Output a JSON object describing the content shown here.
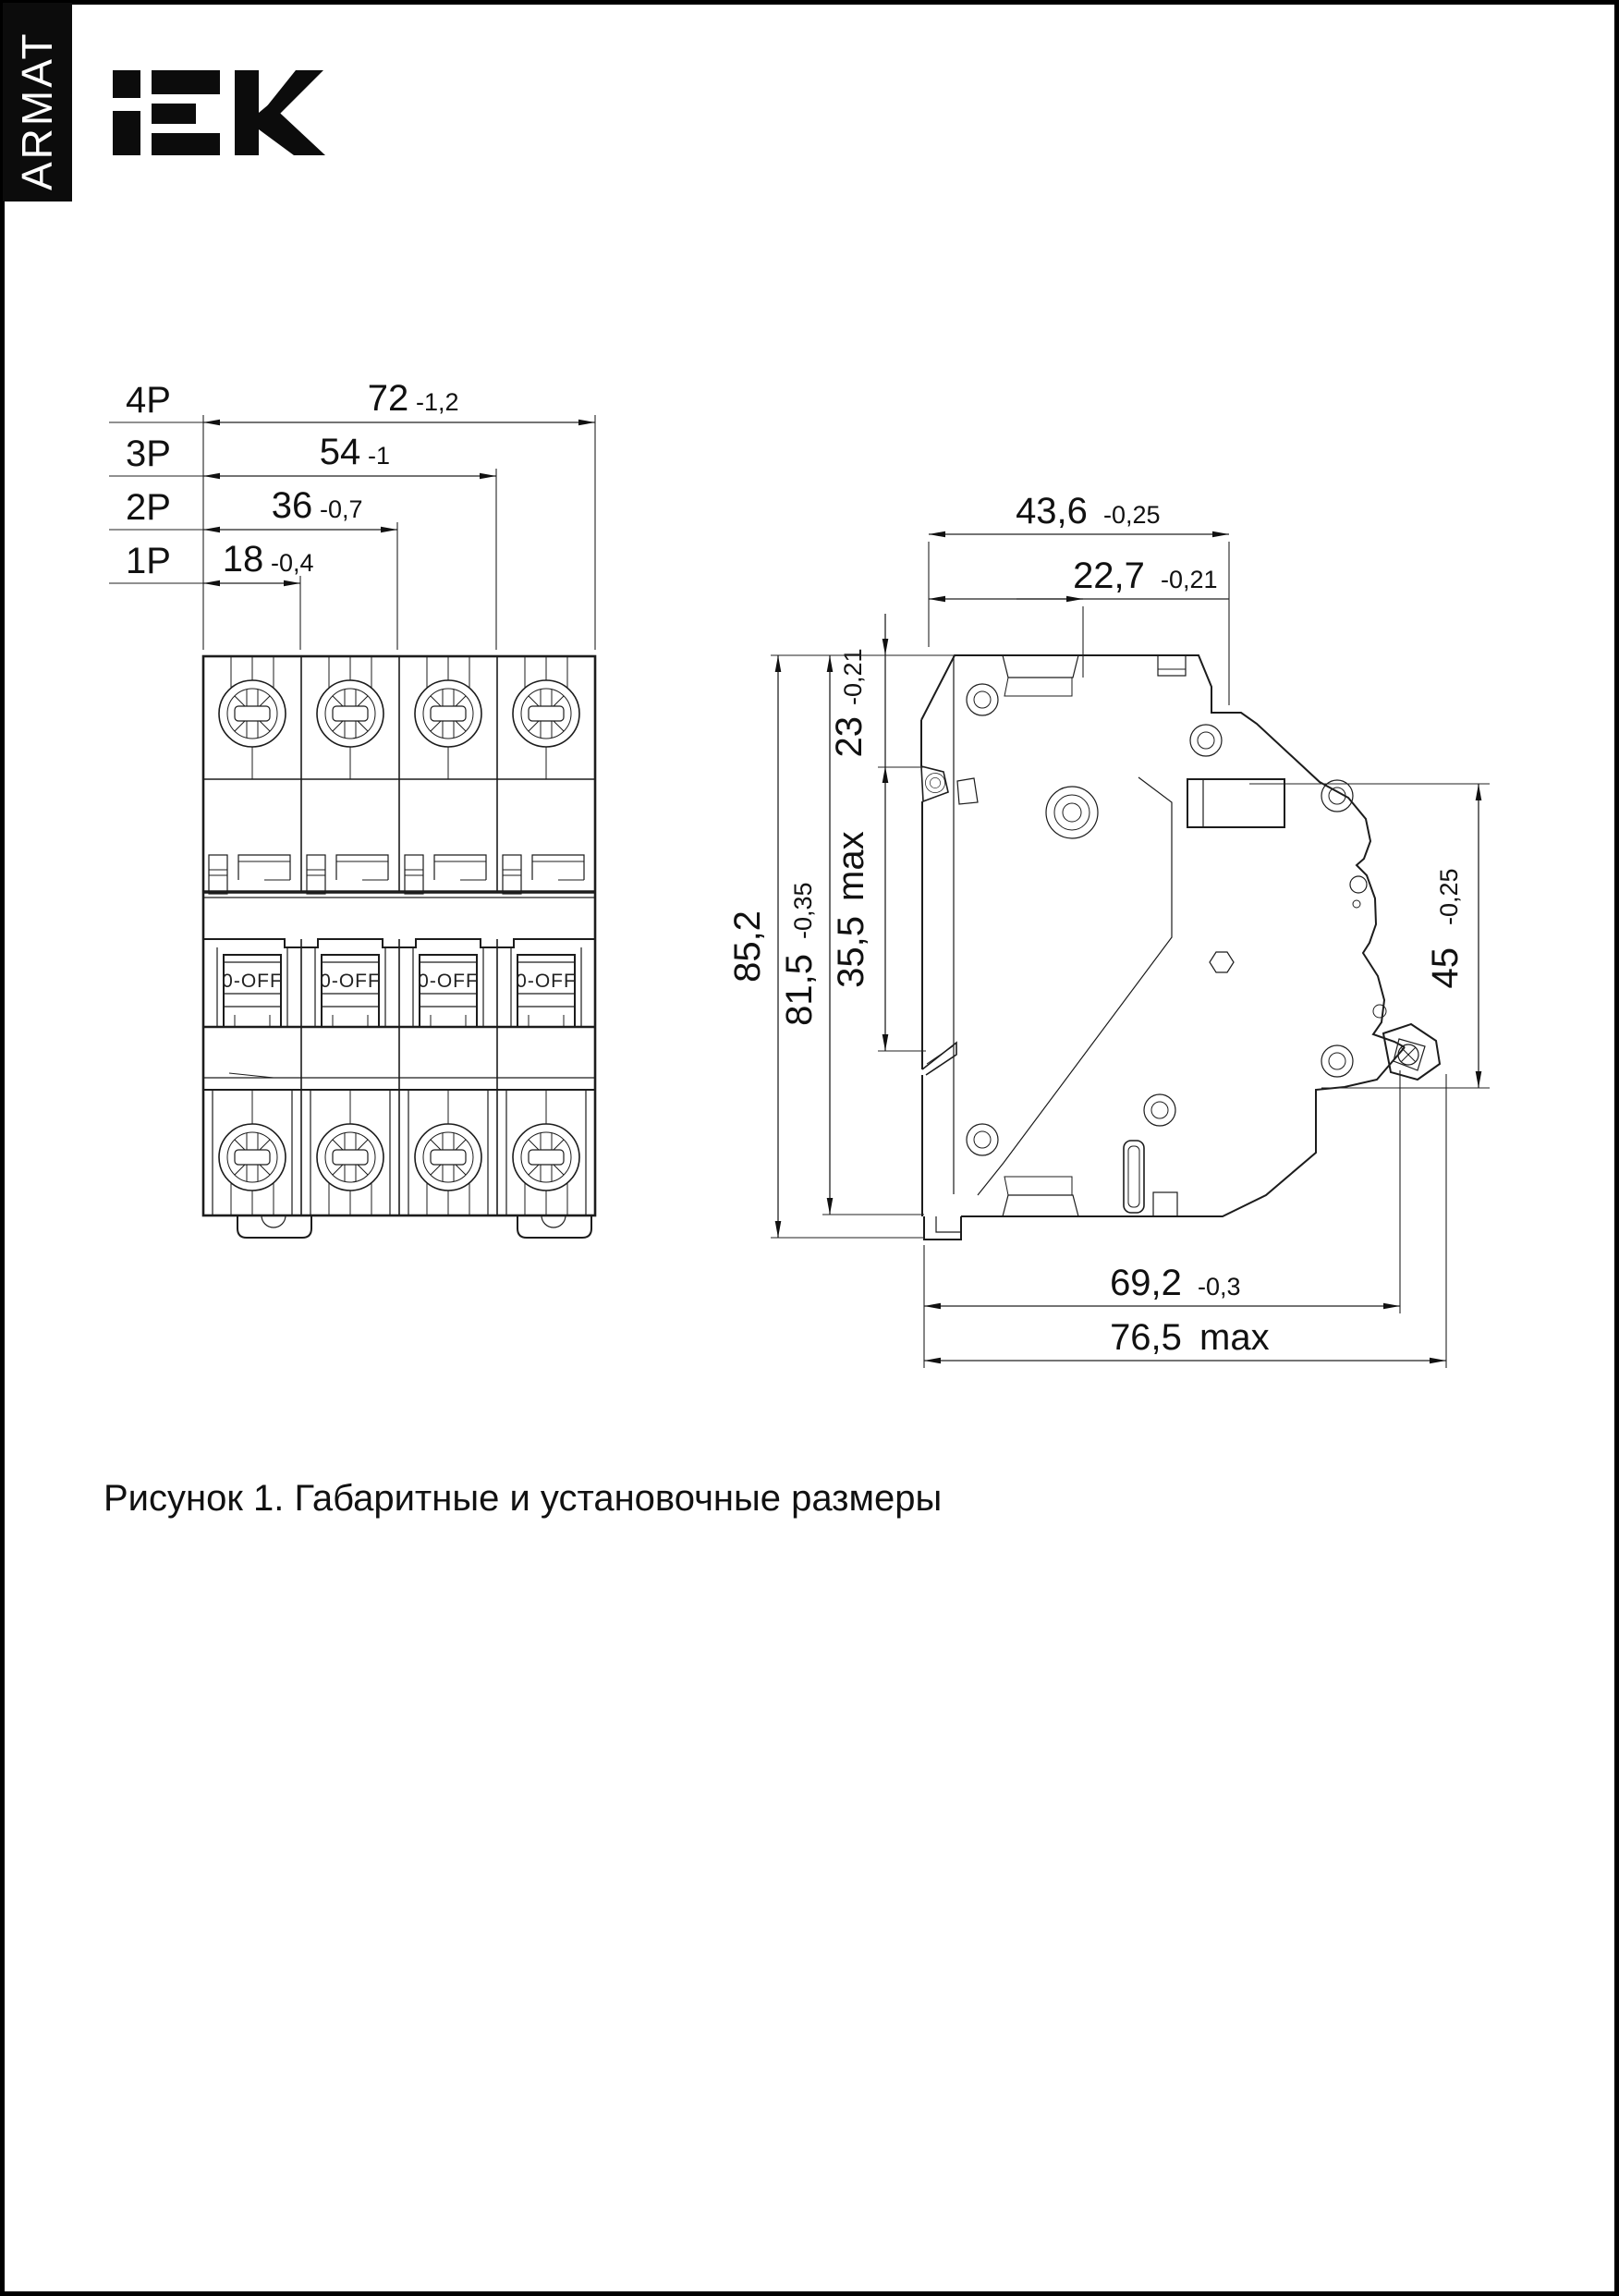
{
  "page": {
    "background": "#ffffff",
    "border_color": "#000000"
  },
  "brand": {
    "sidebar_label": "ARMAT"
  },
  "icons": {
    "iek-logo": "IEK wordmark (black block letters)"
  },
  "front_view": {
    "handle_label": "0-OFF",
    "pole_rows": [
      {
        "label": "4P",
        "value": "72",
        "tolerance": "-1,2"
      },
      {
        "label": "3P",
        "value": "54",
        "tolerance": "-1"
      },
      {
        "label": "2P",
        "value": "36",
        "tolerance": "-0,7"
      },
      {
        "label": "1P",
        "value": "18",
        "tolerance": "-0,4"
      }
    ]
  },
  "side_view": {
    "dims": {
      "overall_depth": {
        "value": "43,6",
        "tolerance": "-0,25"
      },
      "front_depth": {
        "value": "22,7",
        "tolerance": "-0,21"
      },
      "top_to_din": {
        "value": "23",
        "tolerance": "-0,21"
      },
      "din_pocket": {
        "value": "35,5",
        "suffix": "max"
      },
      "overall_height": {
        "value": "85,2"
      },
      "body_height": {
        "value": "81,5",
        "tolerance": "-0,35"
      },
      "panel_aperture": {
        "value": "45",
        "tolerance": "-0,25"
      },
      "mount_depth": {
        "value": "69,2",
        "tolerance": "-0,3"
      },
      "max_depth": {
        "value": "76,5",
        "suffix": "max"
      }
    }
  },
  "figure": {
    "caption": "Рисунок 1. Габаритные и установочные размеры"
  }
}
